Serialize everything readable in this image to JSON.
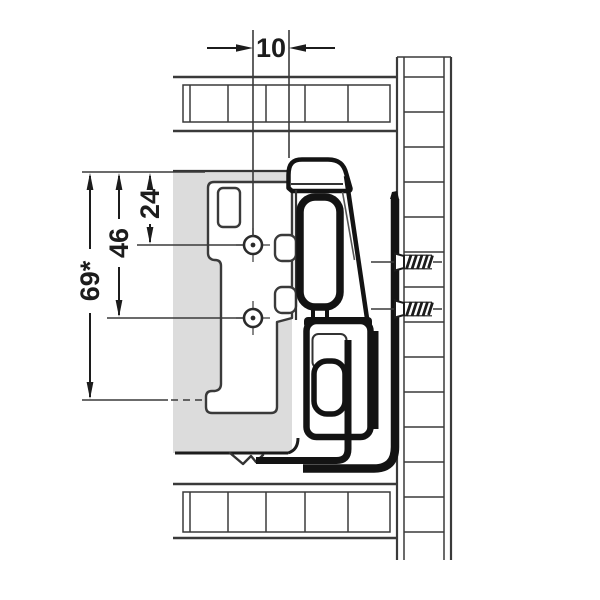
{
  "drawing": {
    "type": "drawer-runner-installation-cross-section",
    "dimensions": {
      "horizontal_offset": "10",
      "hole_top": "24",
      "hole_bottom": "46",
      "total_height": "69*"
    },
    "colors": {
      "thin_line": "#3a3a3a",
      "bold_line": "#131313",
      "panel_fill": "#dcdcdc",
      "background": "#ffffff"
    }
  }
}
